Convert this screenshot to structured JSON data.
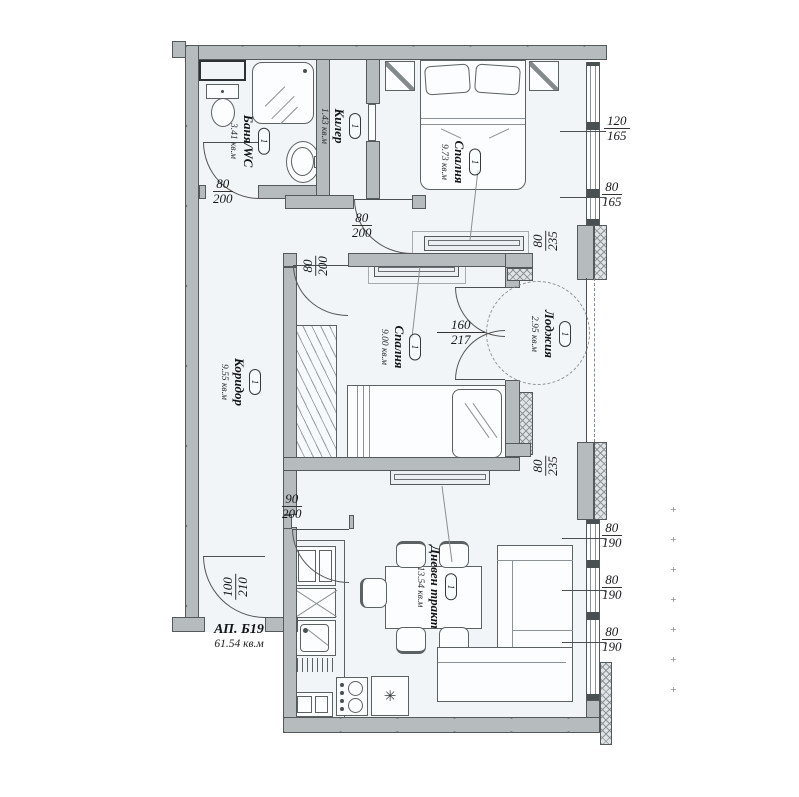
{
  "plan": {
    "apartment": {
      "label": "АП. Б19",
      "area": "61.54 кв.м"
    },
    "rooms": [
      {
        "key": "bath",
        "name": "Баня/WC",
        "area": "3.41 кв.м",
        "tag": "1"
      },
      {
        "key": "closet",
        "name": "Килер",
        "area": "1.43 кв.м",
        "tag": "1"
      },
      {
        "key": "bedroom1",
        "name": "Спалня",
        "area": "9.73 кв.м",
        "tag": "1"
      },
      {
        "key": "bedroom2",
        "name": "Спалня",
        "area": "9.00 кв.м",
        "tag": "1"
      },
      {
        "key": "loggia",
        "name": "Лоджия",
        "area": "2.95 кв.м",
        "tag": "1"
      },
      {
        "key": "corridor",
        "name": "Коридор",
        "area": "9.55 кв.м",
        "tag": "1"
      },
      {
        "key": "living",
        "name": "Дневен тракт",
        "area": "13.54 кв.м",
        "tag": "1"
      }
    ],
    "door_dimensions": [
      {
        "key": "bath_door",
        "w": "80",
        "h": "200"
      },
      {
        "key": "bedroom1_door",
        "w": "80",
        "h": "200"
      },
      {
        "key": "bedroom2_door",
        "w": "80",
        "h": "200"
      },
      {
        "key": "living_door",
        "w": "90",
        "h": "200"
      },
      {
        "key": "entrance_door",
        "w": "100",
        "h": "210"
      },
      {
        "key": "balcony_door",
        "w": "160",
        "h": "217"
      }
    ],
    "window_dimensions": [
      {
        "key": "win_top_1",
        "w": "120",
        "h": "165"
      },
      {
        "key": "win_top_2",
        "w": "80",
        "h": "165"
      },
      {
        "key": "loggia_top",
        "w": "80",
        "h": "235"
      },
      {
        "key": "loggia_bottom",
        "w": "80",
        "h": "235"
      },
      {
        "key": "win_bot_1",
        "w": "80",
        "h": "190"
      },
      {
        "key": "win_bot_2",
        "w": "80",
        "h": "190"
      },
      {
        "key": "win_bot_3",
        "w": "80",
        "h": "190"
      }
    ],
    "icons": {
      "freezer": "✳"
    },
    "colors": {
      "wall": "#b6bbbe",
      "floor": "#f2f5f8",
      "line": "#54595c"
    }
  }
}
